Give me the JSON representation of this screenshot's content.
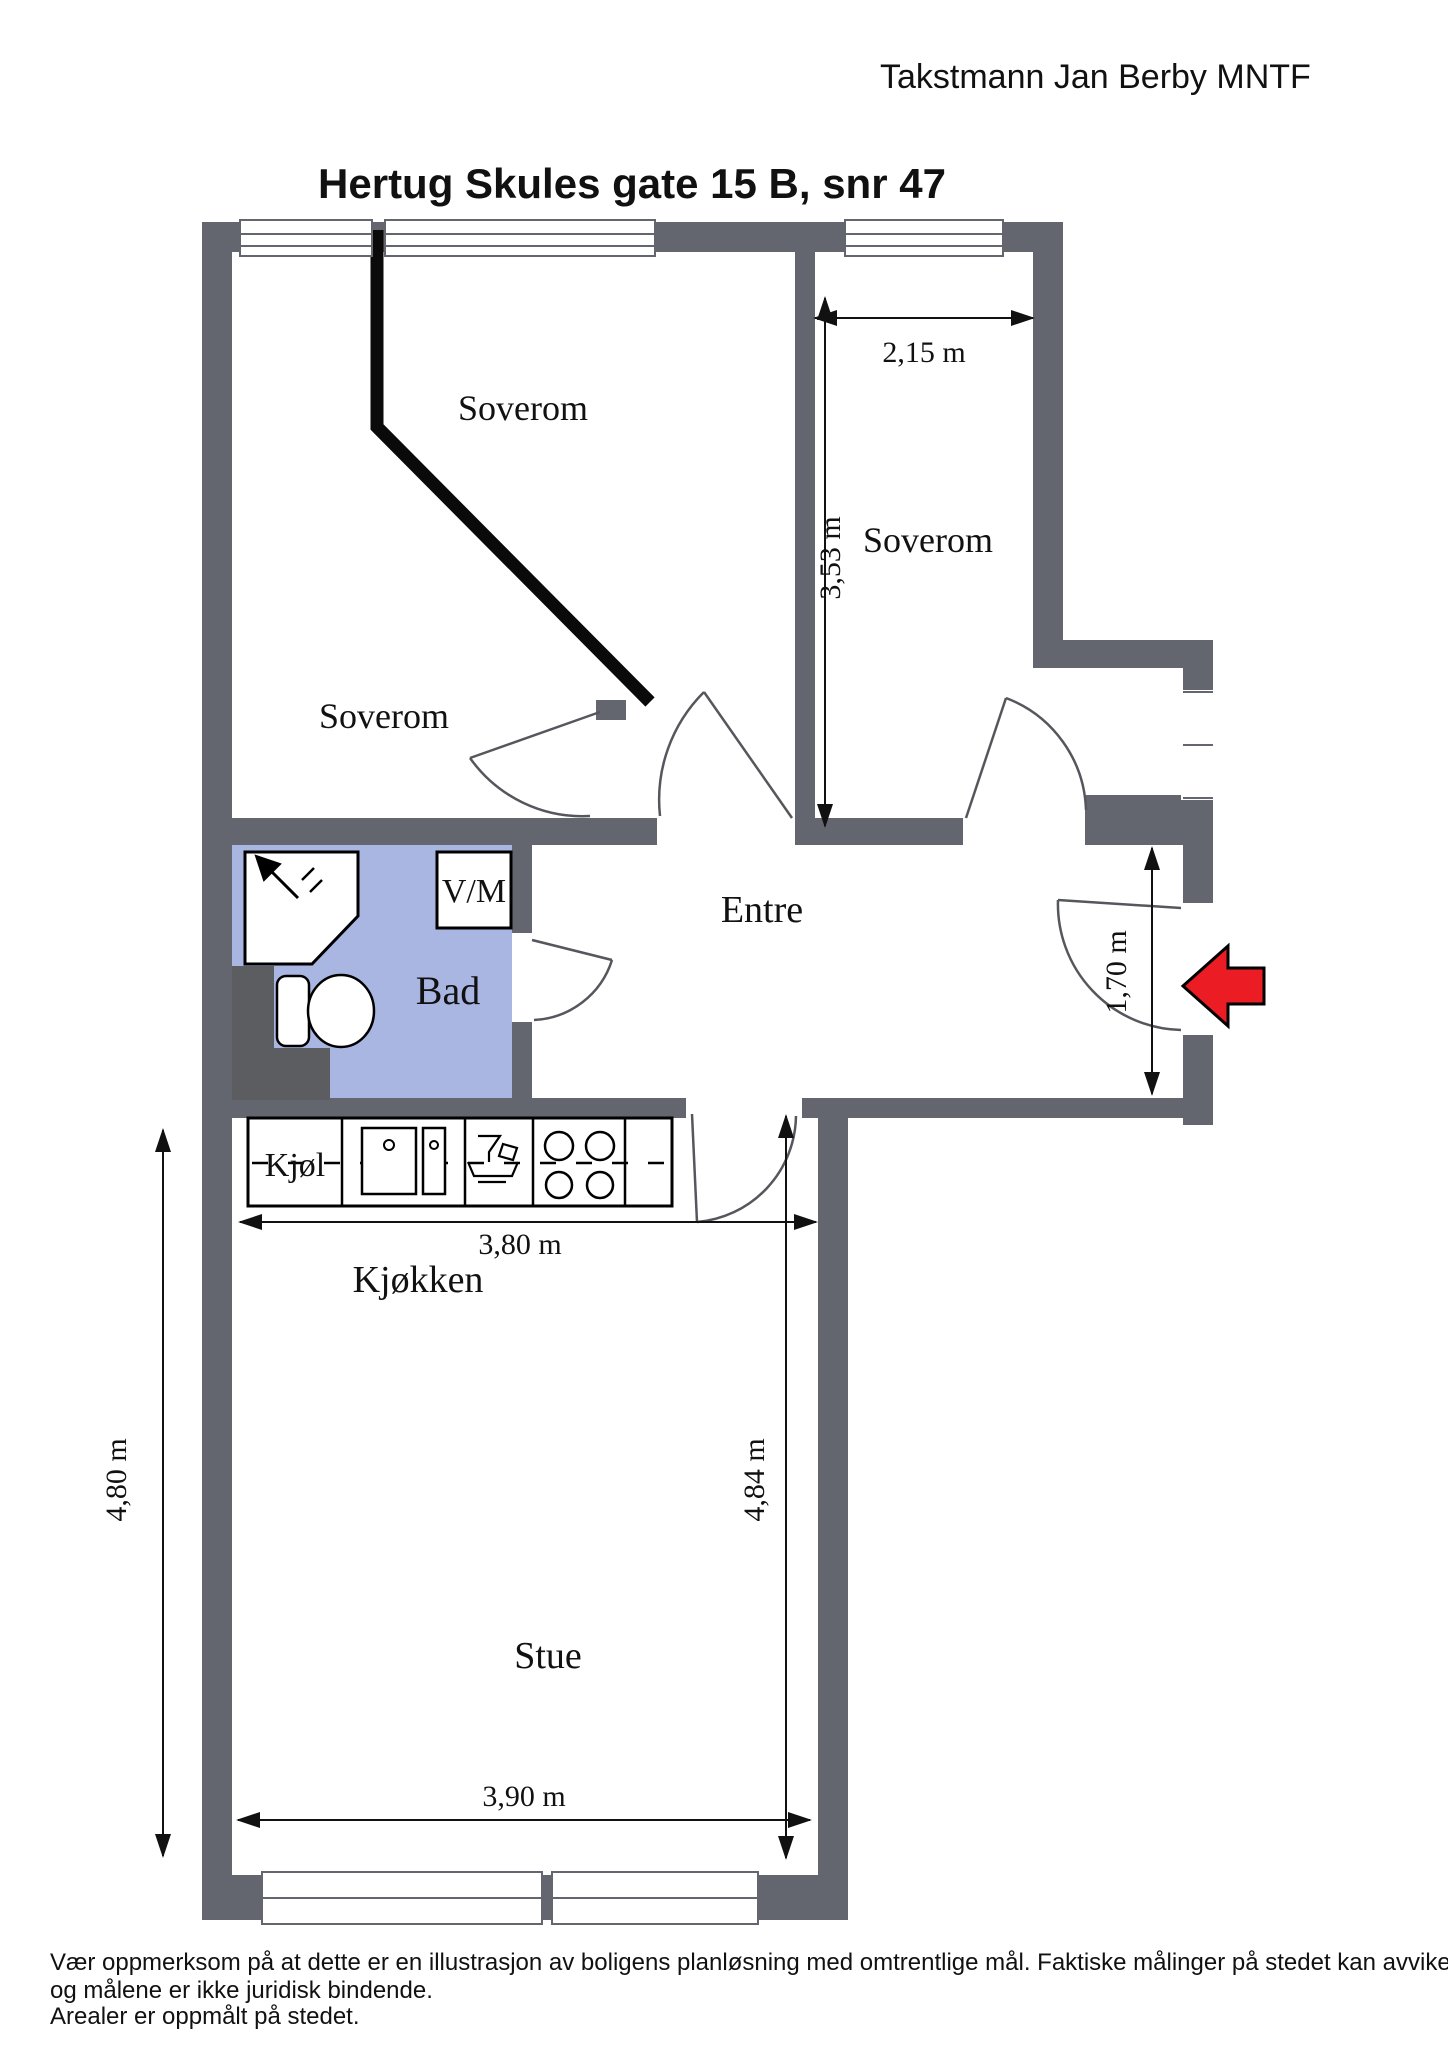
{
  "header": {
    "surveyor": "Takstmann Jan Berby MNTF",
    "title": "Hertug Skules gate 15 B, snr 47"
  },
  "plan": {
    "rooms": {
      "bedroom_left": "Soverom",
      "bedroom_middle": "Soverom",
      "bedroom_right": "Soverom",
      "bathroom": "Bad",
      "laundry": "V/M",
      "entry": "Entre",
      "fridge": "Kjøl",
      "kitchen": "Kjøkken",
      "living_room": "Stue"
    },
    "dimensions": {
      "bedroom_right_width": "2,15 m",
      "bedroom_right_depth": "3,53 m",
      "entry_opening": "1,70 m",
      "kitchen_width": "3,80 m",
      "living_width": "3,90 m",
      "living_depth_left": "4,80 m",
      "living_depth_right": "4,84 m"
    },
    "colors": {
      "wall": "#63666e",
      "wall_dark": "#5b5d61",
      "bathroom": "#a9b6e2",
      "bathroom_label": "#1a2b50",
      "entrance_arrow": "#ec1c24",
      "line": "#111111"
    }
  },
  "footer": {
    "line1": "Vær oppmerksom på at dette er en illustrasjon av boligens planløsning med omtrentlige mål. Faktiske målinger på stedet kan avvike noe",
    "line2": "og målene er ikke juridisk bindende.",
    "line3": "Arealer er oppmålt på stedet."
  }
}
